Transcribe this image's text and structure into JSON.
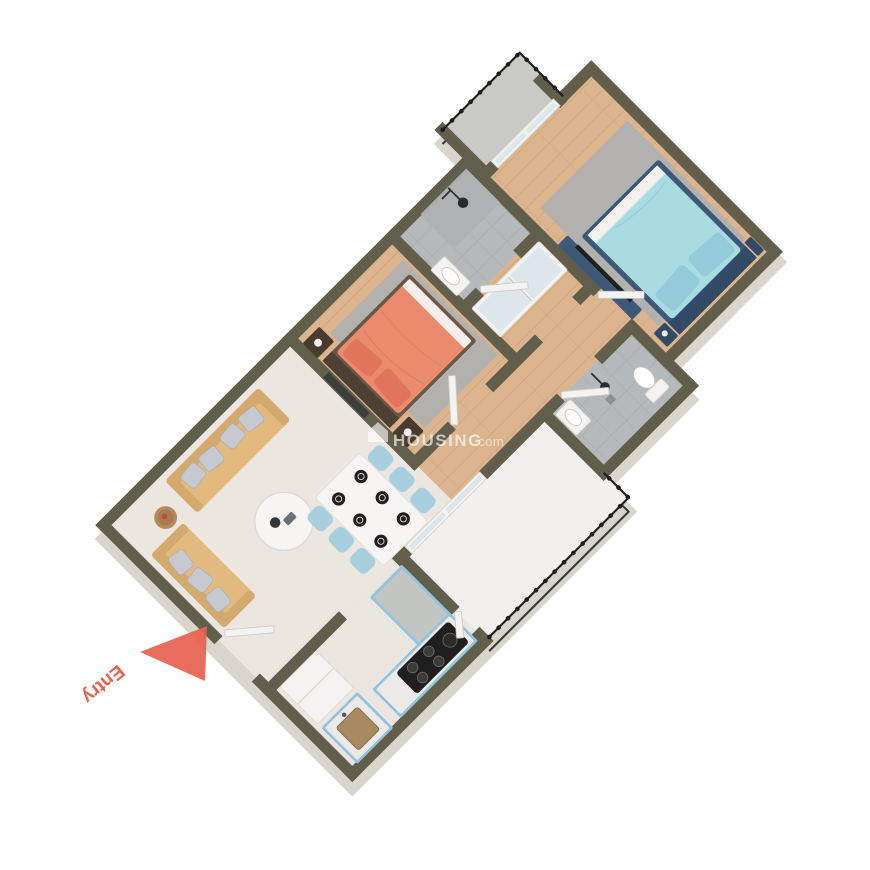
{
  "watermark": {
    "icon": "house-icon",
    "brand": "HOUSING",
    "suffix": ".com"
  },
  "entry": {
    "label": "Entry",
    "arrow": "triangle-arrow"
  },
  "colors": {
    "wall": "#615e4b",
    "extrude": "#d9d5cc",
    "marble": "#ebe6df",
    "balcony": "#f1f0ee",
    "smallbalc": "#c9c9c5",
    "wood": "#dcb48e",
    "woodLine": "#c79f74",
    "tile": "#b6b9bb",
    "tileLine": "#a5a8aa",
    "rug": "#b3b1ad",
    "white": "#f4f3f1",
    "door": "#f4f3f1",
    "glass": "#dde6ea",
    "sofa": "#e3ba7e",
    "sofaDark": "#d3a96d",
    "pillow": "#c6c9d0",
    "cabinet": "#92c3e0",
    "counter": "#c2c6c2",
    "bedCoral": "#e98b6c",
    "bedCoralDark": "#e0755a",
    "frameBrown": "#6a5748",
    "nightstand": "#4a3b2f",
    "bedNavy": "#3e5878",
    "bedNavyDark": "#334a66",
    "bedCyan": "#a9dbe3",
    "bedCyanDark": "#93ccd8",
    "dark": "#1f1f1f",
    "railing": "#1d1d1d",
    "entry": "#e7614e",
    "chairBlue": "#a8cfe0",
    "tableWhite": "#f6f5f3",
    "sinkBasin": "#a88a61",
    "art": "#39403c"
  },
  "rooms": [
    {
      "id": "living-dining",
      "floor": "marble"
    },
    {
      "id": "kitchen",
      "floor": "marble"
    },
    {
      "id": "bedroom-1",
      "floor": "wood"
    },
    {
      "id": "bathroom-1",
      "floor": "tile"
    },
    {
      "id": "passage",
      "floor": "wood"
    },
    {
      "id": "hall",
      "floor": "wood"
    },
    {
      "id": "bedroom-2",
      "floor": "wood"
    },
    {
      "id": "bathroom-2",
      "floor": "tile"
    },
    {
      "id": "balcony",
      "floor": "white-marble"
    },
    {
      "id": "small-balcony",
      "floor": "concrete"
    }
  ],
  "furniture": [
    "sofa-large",
    "sofa-small",
    "coffee-table",
    "side-table",
    "dining-table",
    "dining-chairs",
    "plates",
    "refrigerator",
    "kitchen-counter",
    "sink-counter",
    "gas-stove",
    "double-bed-coral",
    "nightstands",
    "wall-art",
    "area-rug-1",
    "wardrobe-sliding",
    "shower-1",
    "washbasin-1",
    "double-bed-blue",
    "tv-console",
    "area-rug-2",
    "sliding-window",
    "washbasin-2",
    "shower-2",
    "toilet",
    "balcony-railing",
    "small-balcony-railing",
    "entry-door",
    "bedroom-1-door",
    "bedroom-2-door",
    "bathroom-1-door",
    "bathroom-2-door",
    "balcony-door",
    "sliding-glass-door"
  ]
}
